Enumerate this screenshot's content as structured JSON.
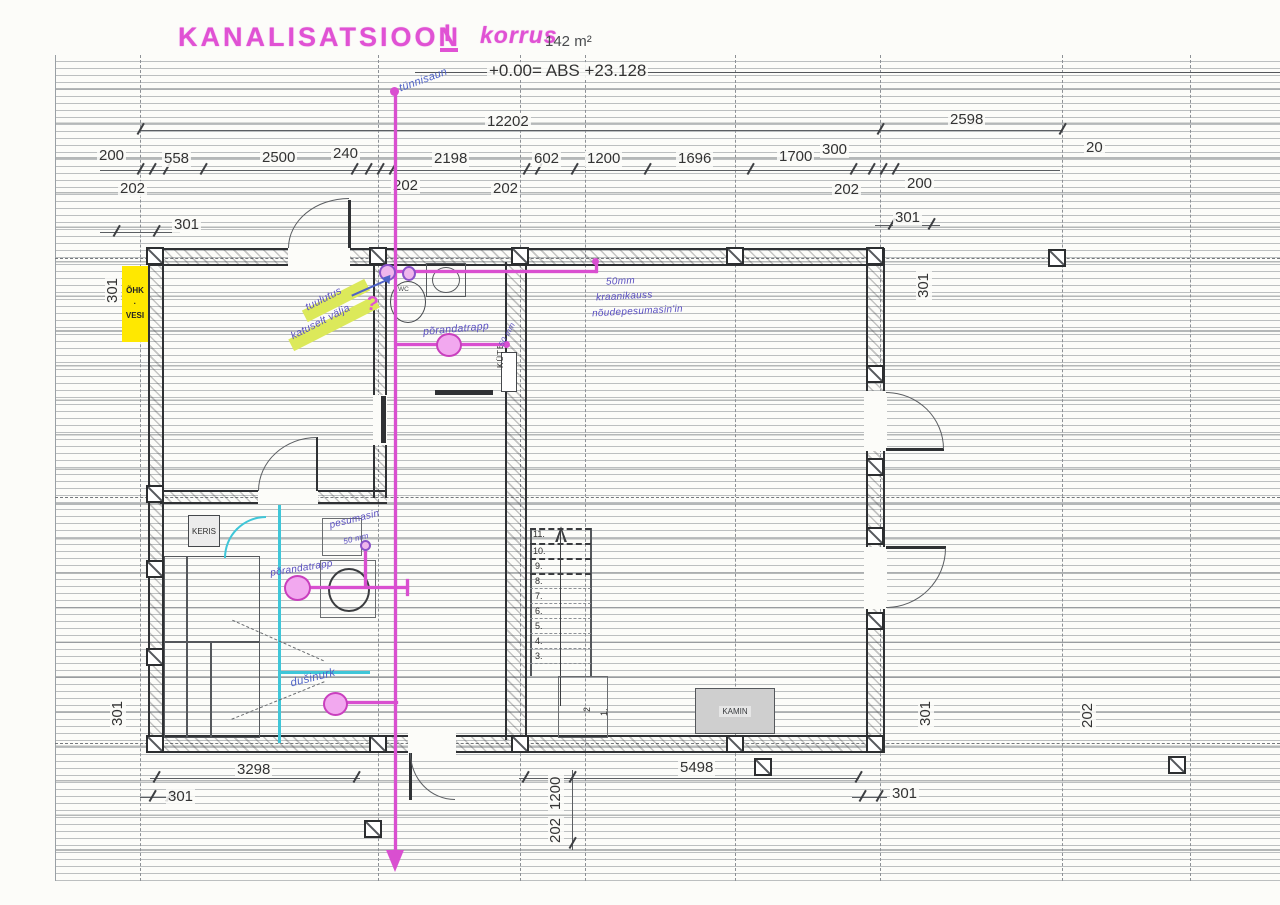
{
  "title": {
    "main": "KANALISATSIOON",
    "numeral": "I",
    "word": "korrus"
  },
  "header": {
    "area": "142 m²",
    "level": "+0.00= ABS +23.128"
  },
  "dims": {
    "overall_top": "12202",
    "deck_right": "2598",
    "t200a": "200",
    "t558": "558",
    "t2500": "2500",
    "t240": "240",
    "t2198": "2198",
    "t602": "602",
    "t1200": "1200",
    "t1696": "1696",
    "t1700": "1700",
    "t300": "300",
    "t200b": "200",
    "t20": "20",
    "t202a": "202",
    "t202b": "202",
    "t202c": "202",
    "t202d": "202",
    "tl301h": "301",
    "tl301v": "301",
    "tr301h": "301",
    "tr301v": "301",
    "b3298": "3298",
    "bl301h": "301",
    "bl301v": "301",
    "b5498": "5498",
    "br301h": "301",
    "br301v": "301",
    "br202v": "202",
    "b1200v": "1200",
    "b202v": "202"
  },
  "rooms": {
    "keris": "KERIS",
    "kamin": "KAMIN",
    "kyte": "KÜTE",
    "shaft_line1": "ÕHK",
    "shaft_line2": "VESI",
    "wc": "WC"
  },
  "stairs": {
    "labels": [
      "11.",
      "10.",
      "9.",
      "8.",
      "7.",
      "6.",
      "5.",
      "4.",
      "3."
    ],
    "lower_labels": [
      "2",
      "1."
    ]
  },
  "notes": {
    "tynnisaun": "tünnisaun",
    "tuulutus_line1": "tuulutus",
    "tuulutus_line2": "katuselt välja",
    "tuulutus_mark": "?",
    "sink_line1": "50mm",
    "sink_line2": "kraanikauss",
    "sink_line3": "nõudepesumasin'in",
    "floordrain1": "põrandatrapp",
    "floordrain1_size": "50 mm",
    "floordrain2": "põrandatrapp",
    "washer": "pesumasin",
    "washer_size": "50 mm",
    "shower": "dušinurk"
  },
  "colors": {
    "marker_pink": "#e052d4",
    "pipe_pink": "#d94fd0",
    "note_purple": "#5b50c2",
    "cyan": "#3fc6d8",
    "highlight_yellow": "#ffe800",
    "highlight_green": "#dce95a"
  }
}
